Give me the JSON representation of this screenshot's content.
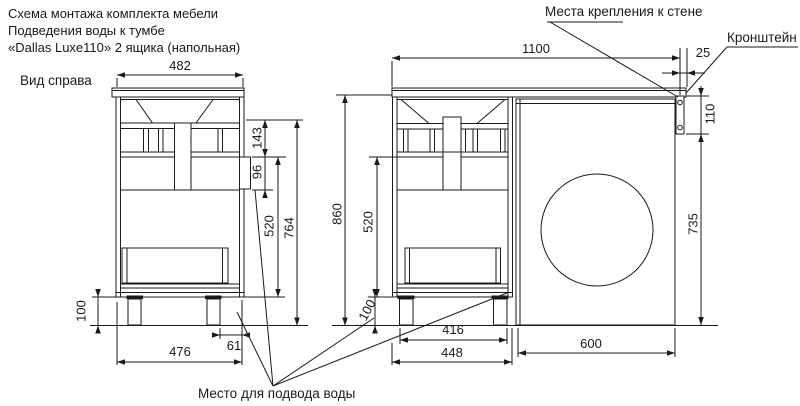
{
  "title": {
    "line1": "Схема монтажа комплекта мебели",
    "line2": "Подведения воды к тумбе",
    "line3": "«Dallas Luxe110» 2 ящика (напольная)"
  },
  "labels": {
    "view_right": "Вид справа",
    "wall_mount_points": "Места крепления к стене",
    "bracket": "Кронштейн",
    "water_supply_area": "Место для подвода воды"
  },
  "dimensions": {
    "side_top_width": "482",
    "total_width": "1100",
    "wall_gap": "25",
    "bracket_height": "110",
    "machine_height": "735",
    "sink_zone_height": "143",
    "cutout_height": "96",
    "side_drawer_zone": "520",
    "side_inner_height": "764",
    "front_height": "860",
    "front_drawer_zone": "520",
    "side_leg_height": "100",
    "front_leg_height": "100",
    "back_offset": "61",
    "side_base_width": "476",
    "leg_span": "416",
    "cabinet_width": "448",
    "machine_width": "600"
  },
  "colors": {
    "line": "#1a1a1a",
    "background": "#ffffff"
  }
}
